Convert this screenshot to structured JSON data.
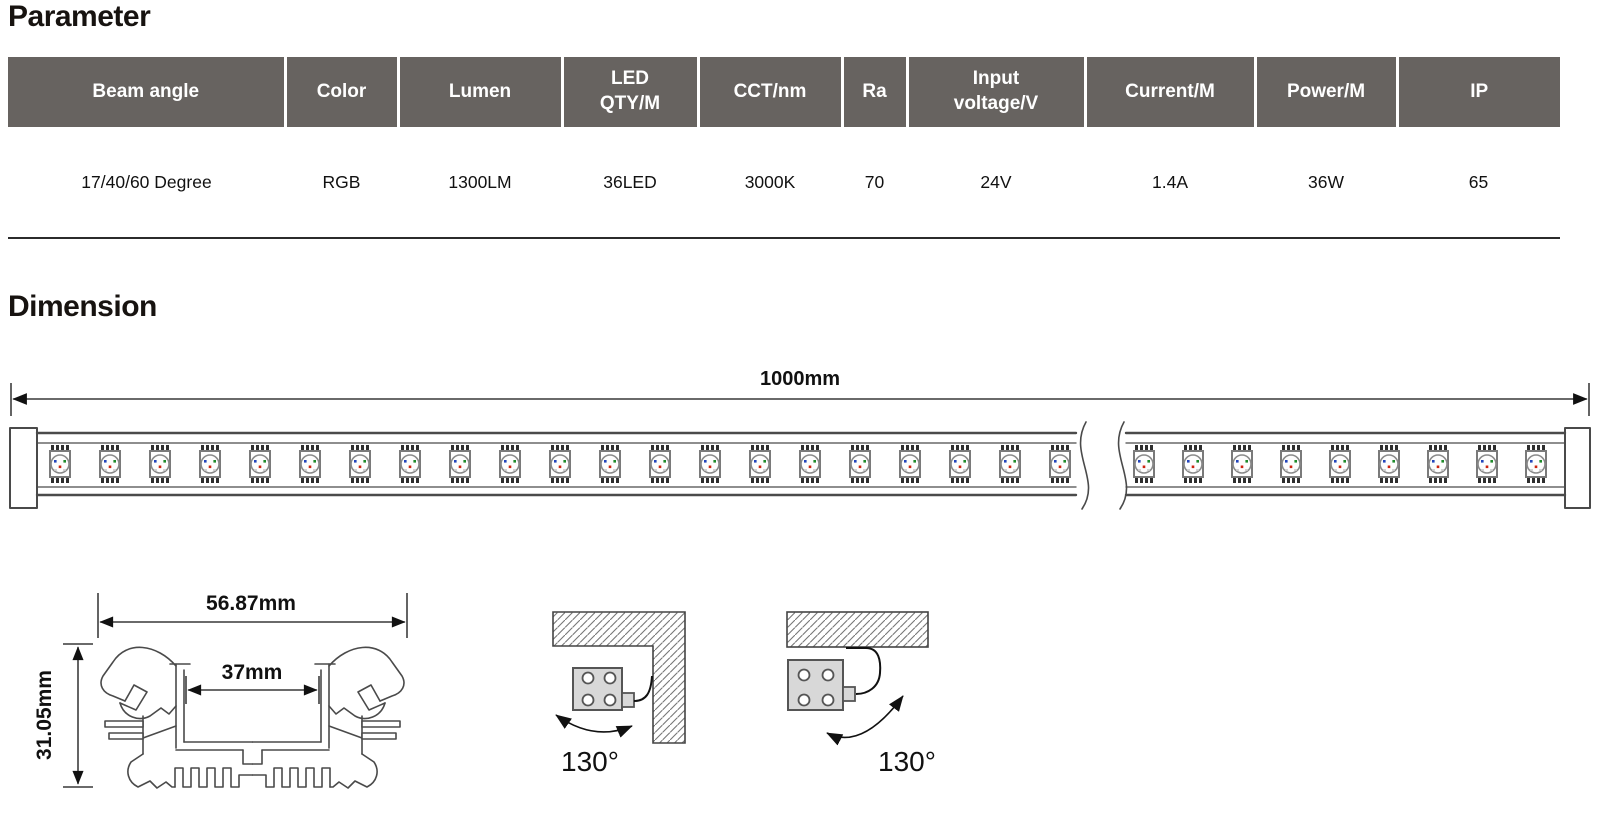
{
  "parameter_section": {
    "title": "Parameter",
    "table": {
      "header_bg": "#676360",
      "columns": [
        "Beam angle",
        "Color",
        "Lumen",
        "LED\nQTY/M",
        "CCT/nm",
        "Ra",
        "Input\nvoltage/V",
        "Current/M",
        "Power/M",
        "IP"
      ],
      "rows": [
        [
          "17/40/60 Degree",
          "RGB",
          "1300LM",
          "36LED",
          "3000K",
          "70",
          "24V",
          "1.4A",
          "36W",
          "65"
        ]
      ]
    }
  },
  "dimension_section": {
    "title": "Dimension",
    "strip": {
      "length_label": "1000mm",
      "led_count_left": 21,
      "led_count_right": 9,
      "led_colors": {
        "blue": "#2244bb",
        "green": "#1e8a2a",
        "red": "#cc2310"
      }
    },
    "profile": {
      "width_label": "56.87mm",
      "inner_width_label": "37mm",
      "height_label": "31.05mm"
    },
    "mounting": [
      {
        "angle_label": "130°"
      },
      {
        "angle_label": "130°"
      }
    ]
  }
}
